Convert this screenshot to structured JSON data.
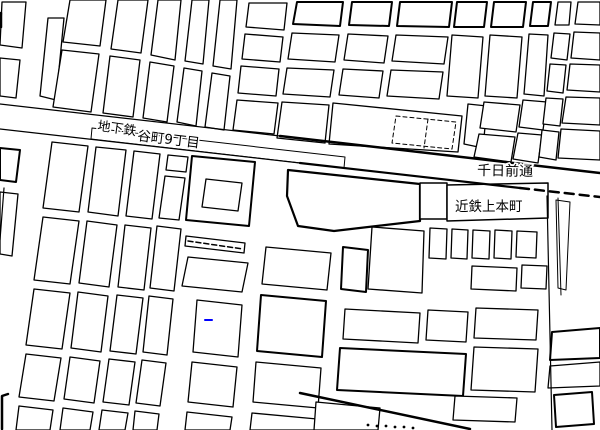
{
  "map": {
    "width": 600,
    "height": 430,
    "background": "#ffffff",
    "line_color": "#000000",
    "accent_blue": "#0000ff",
    "labels": [
      {
        "id": "subway",
        "text": "地下鉄",
        "x": 97,
        "y": 130,
        "size": 13,
        "rotate": 8
      },
      {
        "id": "tanimachi9",
        "text": "谷町9丁目",
        "x": 137,
        "y": 140,
        "size": 13.5,
        "rotate": 7
      },
      {
        "id": "sennichimae",
        "text": "千日前通",
        "x": 477,
        "y": 175,
        "size": 14,
        "rotate": 1
      },
      {
        "id": "kintetsu",
        "text": "近鉄上本町",
        "x": 455,
        "y": 211,
        "size": 13.5,
        "rotate": 0
      }
    ],
    "blocks": [
      {
        "p": "2,2 26,2 22,48 0,45"
      },
      {
        "p": "0,58 20,60 16,98 0,96"
      },
      {
        "p": "48,18 64,18 56,100 40,96"
      },
      {
        "p": "70,0 106,0 100,46 63,42"
      },
      {
        "p": "62,50 99,54 91,112 53,107"
      },
      {
        "p": "118,0 148,0 141,53 111,49"
      },
      {
        "p": "110,56 140,60 133,117 103,113"
      },
      {
        "p": "158,0 181,0 175,60 151,55"
      },
      {
        "p": "150,62 174,66 167,122 143,118"
      },
      {
        "p": "192,0 209,0 203,64 185,61"
      },
      {
        "p": "184,68 202,71 196,126 177,122"
      },
      {
        "p": "220,0 237,0 231,69 213,66"
      },
      {
        "p": "212,73 230,76 224,130 205,127"
      },
      {
        "p": "249,3 287,3 284,30 246,27"
      },
      {
        "p": "245,34 283,37 280,62 242,59"
      },
      {
        "p": "241,66 279,69 276,96 238,93"
      },
      {
        "p": "237,100 278,103 274,134 233,130"
      },
      {
        "p": "297,2 343,2 340,26 293,24",
        "w": 2
      },
      {
        "p": "292,33 339,35 335,62 288,59"
      },
      {
        "p": "287,68 334,70 330,97 283,94"
      },
      {
        "p": "282,102 329,105 325,143 277,138"
      },
      {
        "p": "352,2 392,2 389,26 349,25",
        "w": 2
      },
      {
        "p": "348,34 388,36 384,63 344,60"
      },
      {
        "p": "343,69 383,71 379,98 339,95"
      },
      {
        "p": "333,103 462,116 458,152 329,144"
      },
      {
        "p": "396,116 456,122 452,149 392,143",
        "fill": "none",
        "dash": "4,3",
        "w": 1
      },
      {
        "p": "400,2 452,2 449,27 397,26",
        "w": 2
      },
      {
        "p": "396,35 448,37 444,64 392,61"
      },
      {
        "p": "391,70 443,72 439,99 387,96"
      },
      {
        "p": "457,2 487,2 484,27 454,27",
        "w": 2
      },
      {
        "p": "452,35 483,37 478,98 447,96"
      },
      {
        "p": "468,104 487,106 483,148 464,144"
      },
      {
        "p": "494,2 526,2 523,27 491,27",
        "w": 2
      },
      {
        "p": "490,35 522,37 517,98 485,96"
      },
      {
        "p": "484,102 520,105 516,132 480,128"
      },
      {
        "p": "479,134 515,137 511,162 474,157"
      },
      {
        "p": "533,2 551,2 548,26 530,26",
        "w": 2
      },
      {
        "p": "529,34 548,35 544,96 524,94"
      },
      {
        "p": "523,100 547,102 543,130 519,127"
      },
      {
        "p": "518,133 542,135 538,163 513,159"
      },
      {
        "p": "558,2 571,2 569,25 555,25"
      },
      {
        "p": "554,33 570,34 567,60 551,58"
      },
      {
        "p": "550,64 566,65 563,93 547,91"
      },
      {
        "p": "546,98 563,99 560,126 543,124"
      },
      {
        "p": "542,130 559,132 556,160 539,157"
      },
      {
        "p": "578,2 600,2 600,25 575,24"
      },
      {
        "p": "574,32 600,33 600,60 571,58"
      },
      {
        "p": "570,64 600,65 600,92 567,90"
      },
      {
        "p": "566,97 600,98 600,125 562,123"
      },
      {
        "p": "561,129 600,131 600,160 558,158"
      },
      {
        "p": "92,128 345,157 344,168 91,139",
        "w": 1,
        "name": "subway-station-strip"
      },
      {
        "p": "0,148 20,150 16,182 0,180",
        "w": 2
      },
      {
        "p": "0,192 18,194 12,256 0,254"
      },
      {
        "p": "52,142 88,146 79,212 43,208"
      },
      {
        "p": "43,217 79,221 70,284 34,280"
      },
      {
        "p": "34,289 70,293 62,349 26,345"
      },
      {
        "p": "26,354 61,358 54,401 19,397"
      },
      {
        "p": "19,406 53,410 50,430 16,430"
      },
      {
        "p": "96,147 126,150 118,216 88,212"
      },
      {
        "p": "87,221 117,225 109,287 79,283"
      },
      {
        "p": "78,292 108,296 101,352 71,348"
      },
      {
        "p": "70,357 100,361 94,403 64,399"
      },
      {
        "p": "63,408 93,412 90,430 60,430"
      },
      {
        "p": "134,151 160,154 152,219 126,216"
      },
      {
        "p": "125,225 151,228 144,290 118,287"
      },
      {
        "p": "117,295 143,298 136,354 110,351"
      },
      {
        "p": "109,359 135,362 129,405 103,402"
      },
      {
        "p": "102,410 128,413 125,430 99,430"
      },
      {
        "p": "168,155 188,157 186,172 166,170"
      },
      {
        "p": "165,176 185,178 179,220 159,218"
      },
      {
        "p": "157,226 181,229 174,291 150,288"
      },
      {
        "p": "149,296 173,299 167,355 143,352"
      },
      {
        "p": "142,360 166,363 160,406 136,403"
      },
      {
        "p": "135,411 159,414 157,430 133,430"
      },
      {
        "p": "192,156 255,162 249,226 186,220",
        "w": 2,
        "name": "temple-block-outer"
      },
      {
        "p": "206,179 242,183 238,211 202,207",
        "name": "temple-block-inner"
      },
      {
        "p": "186,236 245,243 244,253 185,246",
        "name": "hatched-strip"
      },
      {
        "p": "188,257 248,263 242,292 182,286"
      },
      {
        "p": "197,300 242,305 238,357 193,352"
      },
      {
        "p": "192,362 237,367 233,407 188,402"
      },
      {
        "p": "187,412 232,417 230,430 185,430"
      },
      {
        "p": "266,247 331,253 327,290 262,284"
      },
      {
        "p": "261,295 326,301 322,357 257,351",
        "w": 2
      },
      {
        "p": "256,362 321,368 318,408 253,402"
      },
      {
        "p": "252,413 317,419 315,430 250,430"
      },
      {
        "p": "288,170 420,184 420,221 334,231 298,226 287,196",
        "w": 2.2,
        "name": "terminal-block"
      },
      {
        "p": "420,183 447,183 447,219 420,219",
        "w": 1.5,
        "name": "kintetsu-building-tower"
      },
      {
        "p": "447,185 548,183 548,218 447,221",
        "w": 1.5,
        "name": "kintetsu-building-main"
      },
      {
        "p": "343,247 368,250 366,292 341,289",
        "w": 2
      },
      {
        "p": "372,227 424,231 422,293 368,289"
      },
      {
        "p": "430,228 447,229 446,259 429,258",
        "name": "platform"
      },
      {
        "p": "452,229 468,230 467,259 451,258",
        "name": "platform"
      },
      {
        "p": "473,230 490,231 489,259 472,258",
        "name": "platform"
      },
      {
        "p": "495,230 512,231 511,259 494,258",
        "name": "platform"
      },
      {
        "p": "517,231 537,232 536,258 516,257",
        "name": "platform"
      },
      {
        "p": "472,266 517,268 516,291 471,289"
      },
      {
        "p": "522,265 547,266 546,289 521,288"
      },
      {
        "p": "345,309 420,313 418,343 343,339"
      },
      {
        "p": "428,310 468,312 466,342 426,340"
      },
      {
        "p": "476,308 538,310 536,340 474,338"
      },
      {
        "p": "340,348 466,354 463,396 337,390",
        "w": 2
      },
      {
        "p": "474,347 538,349 535,392 471,390"
      },
      {
        "p": "455,396 517,398 515,422 453,420"
      },
      {
        "p": "316,402 380,408 378,430 314,430"
      },
      {
        "p": "556,200 570,202 566,290 558,288",
        "w": 1
      },
      {
        "p": "552,332 600,328 600,358 550,360",
        "w": 2
      },
      {
        "p": "550,366 600,362 600,386 548,388"
      },
      {
        "p": "554,395 592,392 594,424 556,427",
        "w": 2
      }
    ],
    "lines": [
      {
        "p": "0,104 280,136",
        "w": 1.2,
        "name": "road-band-top"
      },
      {
        "p": "280,136 600,173",
        "w": 2.5,
        "name": "road-band-top-bold"
      },
      {
        "p": "0,129 300,163",
        "w": 1.2,
        "name": "road-band-bottom"
      },
      {
        "p": "300,163 520,188",
        "w": 2.2,
        "name": "road-band-bottom-bold"
      },
      {
        "p": "520,188 600,197",
        "w": 2.5,
        "dash": "9,6",
        "name": "road-band-bottom-dashed"
      },
      {
        "p": "4,188 0,240",
        "w": 1.2,
        "name": "avenue-left-edge"
      },
      {
        "p": "300,393 470,429",
        "w": 2.5,
        "name": "diagonal-street"
      },
      {
        "p": "188,241 243,249",
        "w": 1.5,
        "dash": "5,3",
        "name": "hatch-line"
      },
      {
        "p": "428,119 424,148",
        "w": 1,
        "dash": "4,3",
        "name": "dashed-building-divider"
      },
      {
        "p": "547,196 552,430",
        "w": 1.2,
        "name": "east-street-left"
      },
      {
        "p": "558,198 561,295",
        "w": 1,
        "name": "east-street-right"
      },
      {
        "p": "8,394 2,396 2,429",
        "w": 2.5,
        "name": "corner-mark"
      },
      {
        "p": "1,13 1,27",
        "w": 2.5,
        "name": "edge-tick"
      },
      {
        "p": "205,320 212,320",
        "w": 2,
        "color": "#0000ff",
        "name": "blue-marker"
      }
    ],
    "dots": [
      {
        "x": 368,
        "y": 425
      },
      {
        "x": 377,
        "y": 426
      },
      {
        "x": 386,
        "y": 426
      },
      {
        "x": 395,
        "y": 427
      },
      {
        "x": 404,
        "y": 427
      },
      {
        "x": 413,
        "y": 428
      }
    ]
  }
}
